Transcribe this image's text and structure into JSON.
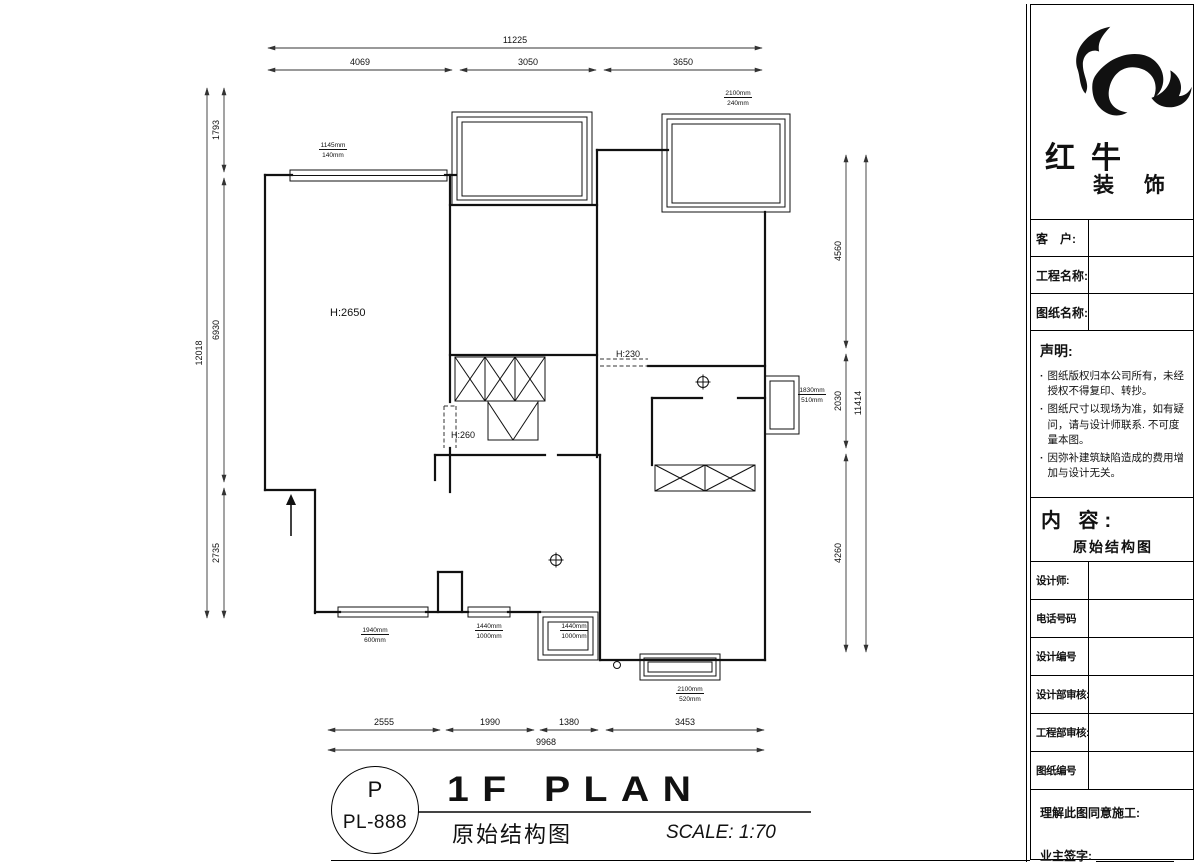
{
  "brand": {
    "name_main": "红牛",
    "name_sub": "装 饰"
  },
  "titleblock": {
    "fields_top": [
      {
        "label": "客　户:"
      },
      {
        "label": "工程名称:"
      },
      {
        "label": "图纸名称:"
      }
    ],
    "statement": {
      "title": "声明:",
      "items": [
        "图纸版权归本公司所有，未经授权不得复印、转抄。",
        "图纸尺寸以现场为准，如有疑问，请与设计师联系. 不可度量本图。",
        "因弥补建筑缺陷造成的费用增加与设计无关。"
      ]
    },
    "content": {
      "label": "内 容:",
      "value": "原始结构图"
    },
    "fields_bottom": [
      {
        "label": "设计师:"
      },
      {
        "label": "电话号码"
      },
      {
        "label": "设计编号"
      },
      {
        "label": "设计部审核:"
      },
      {
        "label": "工程部审核:"
      },
      {
        "label": "图纸编号"
      }
    ],
    "footer": {
      "line1": "理解此图同意施工:",
      "line2": "业主签字:"
    }
  },
  "stamp": {
    "letter": "P",
    "code": "PL-888"
  },
  "titlebar": {
    "plan_title": "1F PLAN",
    "plan_subtitle": "原始结构图",
    "scale": "SCALE: 1:70"
  },
  "dimensions": {
    "top": {
      "total": "11225",
      "segments": [
        "4069",
        "3050",
        "3650"
      ]
    },
    "left": {
      "total": "12018",
      "segments": [
        "1793",
        "6930",
        "2735"
      ]
    },
    "right": {
      "total": "11414",
      "segments": [
        "4560",
        "2030",
        "4260"
      ]
    },
    "bottom": {
      "total": "9968",
      "segments": [
        "2555",
        "1990",
        "1380",
        "3453"
      ]
    }
  },
  "room_labels": [
    "H:2650",
    "H:260",
    "H:230"
  ],
  "window_labels": [
    {
      "w": "1145mm",
      "h": "140mm"
    },
    {
      "w": "2100mm",
      "h": "240mm"
    },
    {
      "w": "1830mm",
      "h": "510mm"
    },
    {
      "w": "1940mm",
      "h": "600mm"
    },
    {
      "w": "1440mm",
      "h": "1000mm"
    },
    {
      "w": "1440mm",
      "h": "1000mm"
    },
    {
      "w": "2100mm",
      "h": "520mm"
    }
  ]
}
